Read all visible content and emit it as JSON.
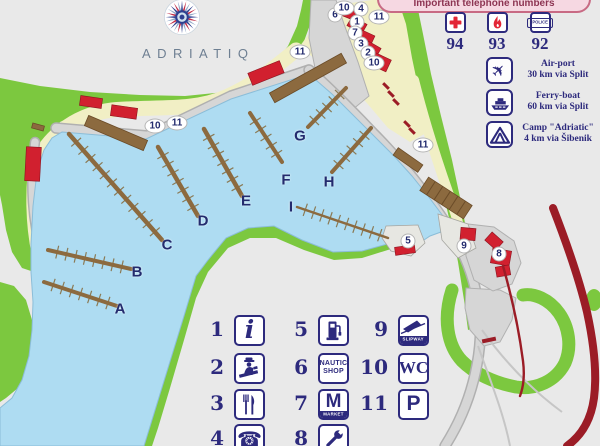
{
  "logo": {
    "wordmark": "ADRIATIQ"
  },
  "phone_panel": {
    "title": "Important telephone numbers",
    "entries": [
      {
        "icon": "first-aid-icon",
        "number": "94"
      },
      {
        "icon": "fire-icon",
        "number": "93"
      },
      {
        "icon": "police-icon",
        "label": "POLICE",
        "number": "92"
      }
    ]
  },
  "info_panel": {
    "items": [
      {
        "icon": "airplane-icon",
        "line1": "Air-port",
        "line2": "30 km via Split"
      },
      {
        "icon": "ferry-icon",
        "line1": "Ferry-boat",
        "line2": "60 km via Split"
      },
      {
        "icon": "camp-icon",
        "line1": "Camp \"Adriatic\"",
        "line2": "4 km via Šibenik"
      }
    ]
  },
  "map": {
    "pier_labels": [
      {
        "label": "A",
        "x": 120,
        "y": 309
      },
      {
        "label": "B",
        "x": 137,
        "y": 272
      },
      {
        "label": "C",
        "x": 167,
        "y": 245
      },
      {
        "label": "D",
        "x": 203,
        "y": 221
      },
      {
        "label": "E",
        "x": 246,
        "y": 201
      },
      {
        "label": "F",
        "x": 286,
        "y": 180
      },
      {
        "label": "G",
        "x": 300,
        "y": 136
      },
      {
        "label": "H",
        "x": 329,
        "y": 182
      },
      {
        "label": "I",
        "x": 291,
        "y": 207
      }
    ],
    "markers": [
      {
        "label": "6",
        "x": 335,
        "y": 15
      },
      {
        "label": "10",
        "x": 344,
        "y": 8
      },
      {
        "label": "4",
        "x": 361,
        "y": 9
      },
      {
        "label": "1",
        "x": 357,
        "y": 22
      },
      {
        "label": "11",
        "x": 379,
        "y": 17
      },
      {
        "label": "7",
        "x": 355,
        "y": 33
      },
      {
        "label": "3",
        "x": 361,
        "y": 44
      },
      {
        "label": "2",
        "x": 368,
        "y": 53
      },
      {
        "label": "10",
        "x": 374,
        "y": 63
      },
      {
        "label": "11",
        "x": 300,
        "y": 52
      },
      {
        "label": "10",
        "x": 155,
        "y": 126
      },
      {
        "label": "11",
        "x": 177,
        "y": 123
      },
      {
        "label": "11",
        "x": 423,
        "y": 145
      },
      {
        "label": "5",
        "x": 408,
        "y": 241
      },
      {
        "label": "9",
        "x": 464,
        "y": 246
      },
      {
        "label": "8",
        "x": 499,
        "y": 254
      }
    ]
  },
  "legend": {
    "items": [
      {
        "number": "1",
        "icon": "info-icon",
        "text": "i"
      },
      {
        "number": "2",
        "icon": "customs-officer-icon"
      },
      {
        "number": "3",
        "icon": "restaurant-icon"
      },
      {
        "number": "4",
        "icon": "telephone-icon",
        "text": "☎"
      },
      {
        "number": "5",
        "icon": "fuel-station-icon"
      },
      {
        "number": "6",
        "icon": "nautic-shop-icon",
        "lines": [
          "NAUTIC",
          "SHOP"
        ]
      },
      {
        "number": "7",
        "icon": "market-icon",
        "letter": "M",
        "caption": "MARKET"
      },
      {
        "number": "8",
        "icon": "workshop-icon"
      },
      {
        "number": "9",
        "icon": "slipway-icon",
        "caption": "SLIPWAY"
      },
      {
        "number": "10",
        "icon": "wc-icon",
        "text": "WC"
      },
      {
        "number": "11",
        "icon": "parking-icon",
        "text": "P"
      }
    ]
  },
  "colors": {
    "navy": "#2d2a7d",
    "red": "#d1202f",
    "darkred": "#9b1c26",
    "green": "#7cc83f",
    "water": "#aedcf2",
    "beige": "#f1efc5",
    "brown": "#8c6a3f",
    "background": "#e9e9e9",
    "banner_pink": "#f6d8e2"
  }
}
